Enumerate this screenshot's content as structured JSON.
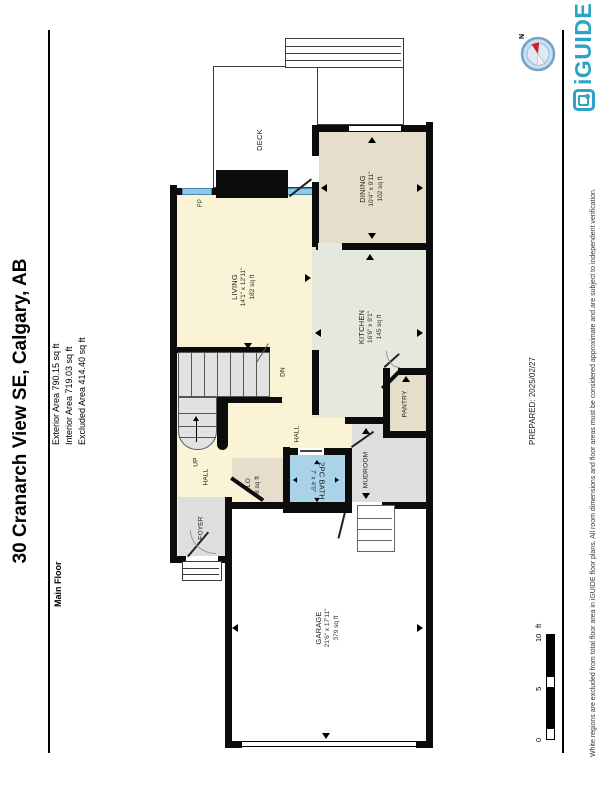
{
  "header": {
    "title": "30 Cranarch View SE, Calgary, AB",
    "floor_label": "Main Floor",
    "areas": {
      "exterior": "Exterior Area 790.15 sq ft",
      "interior": "Interior Area 719.03 sq ft",
      "excluded": "Excluded Area 414.40 sq ft"
    }
  },
  "footer": {
    "prepared": "PREPARED: 2025/02/27",
    "disclaimer": "White regions are excluded from total floor area in iGUIDE floor plans. All room dimensions and floor areas must be considered approximate and are subject to independent verification.",
    "brand": "iGUIDE"
  },
  "compass": {
    "north": "N"
  },
  "scale_bar": {
    "t0": "0",
    "t5": "5",
    "t10": "10",
    "unit": "ft"
  },
  "rooms": {
    "garage": {
      "name": "GARAGE",
      "dims": "21'6\" x 17'11\"",
      "area": "379 sq ft"
    },
    "living": {
      "name": "LIVING",
      "dims": "14'1\" x 12'11\"",
      "area": "182 sq ft"
    },
    "dining": {
      "name": "DINING",
      "dims": "10'4\" x 9'11\"",
      "area": "102 sq ft"
    },
    "kitchen": {
      "name": "KITCHEN",
      "dims": "16'6\" x 9'1\"",
      "area": "145 sq ft"
    },
    "bath": {
      "name": "2PC BATH",
      "dims": "7' x 4'9\""
    },
    "closet": {
      "name": "CLO",
      "area": "8 sq ft"
    },
    "pantry": {
      "name": "PANTRY"
    },
    "mudroom": {
      "name": "MUDROOM"
    },
    "foyer": {
      "name": "FOYER"
    },
    "deck": {
      "name": "DECK"
    },
    "hall_a": {
      "name": "HALL"
    },
    "hall_b": {
      "name": "HALL"
    },
    "stairs_up": {
      "name": "UP"
    },
    "stairs_dn": {
      "name": "DN"
    },
    "fireplace": {
      "name": "FP"
    }
  },
  "colors": {
    "floor_cream": "#faf3d6",
    "floor_tan": "#e6ddca",
    "floor_sage": "#e4e8dd",
    "floor_grey": "#dedede",
    "bath_blue": "#a8d3e8",
    "window_blue": "#8ec9e6",
    "brand_teal": "#2ea3c6",
    "wall": "#0c0c0c"
  }
}
